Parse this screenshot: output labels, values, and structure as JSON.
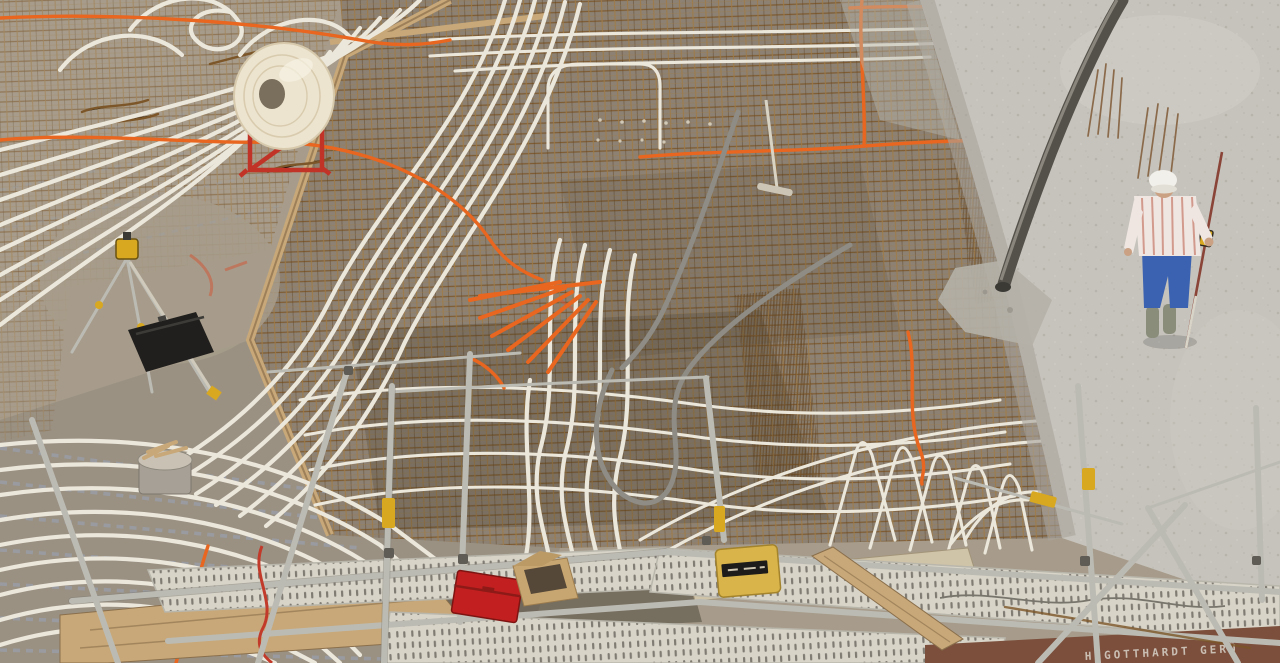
{
  "image": {
    "kind": "photograph",
    "view": "elevated aerial view, no visible UI chrome",
    "subject": "Construction site: reinforced concrete floor slab with underfloor-heating pipes and conduits being embedded while fresh concrete is poured",
    "width_px": 1280,
    "height_px": 663
  },
  "scene": {
    "description": "Elevated view over a building slab. Left: concrete deck with lattice girders and white PEX heating pipes laid in sweeping parallel curves; a large white pipe coil sits on a red spool stand; a surveyor's tripod with yellow laser level and a black equipment case stand on the slab. Center: dense rusty rebar mesh threaded with white pipes, hairpin loops, grey flexible conduit and orange electrical conduit. Right: freshly poured wet grey concrete with a dark concrete-pump hose hanging down, clusters of rebar dowels, and a worker checking the pour with a levelling staff. Foreground: scaffolding with galvanized tubes, perforated steel walkway decks, wooden planks, a red toolbox, a cardboard box and a yellow tool case.",
    "elements": [
      {
        "name": "rebar-mesh",
        "description": "rusty steel reinforcement grid covering the slab centre"
      },
      {
        "name": "heating-pipes",
        "description": "white PEX underfloor-heating tubes in parallel curves and hairpin loops"
      },
      {
        "name": "pipe-spool",
        "description": "white tubing coil on a red steel spool stand"
      },
      {
        "name": "orange-conduits",
        "description": "orange electrical conduit runs and a fanned bundle of conduit stubs"
      },
      {
        "name": "grey-conduit",
        "description": "grey flexible conduit forming a large U-loop"
      },
      {
        "name": "surveyor-tripod",
        "description": "aluminium tripod with yellow rotary laser level"
      },
      {
        "name": "equipment-case",
        "description": "black instrument case lying on the slab"
      },
      {
        "name": "fresh-concrete-pour",
        "description": "wet grey concrete surface advancing from the right"
      },
      {
        "name": "concrete-pump-hose",
        "description": "dark pump hose hanging diagonally over the pour"
      },
      {
        "name": "rebar-dowels",
        "description": "clusters of thin starter bars protruding from the fresh concrete"
      },
      {
        "name": "construction-worker",
        "description": "worker on the fresh concrete holding a levelling staff"
      },
      {
        "name": "scaffolding",
        "description": "foreground scaffold with tubes, braces and perforated walkway decks"
      },
      {
        "name": "red-toolbox",
        "description": "red metal toolbox on the walkway"
      },
      {
        "name": "cardboard-box",
        "description": "open cardboard box beside the toolbox"
      },
      {
        "name": "yellow-case",
        "description": "yellow machine case with black label on a plank"
      },
      {
        "name": "wood-plank",
        "description": "timber planks and a leaning board on the scaffold"
      },
      {
        "name": "concrete-rake",
        "description": "long-handled rake lying on the mesh"
      },
      {
        "name": "mortar-bucket",
        "description": "bucket with timber offcuts on the left slab"
      }
    ]
  },
  "worker": {
    "hard_hat": "white",
    "shirt": "white short-sleeve shirt with red stripes",
    "trousers": "blue jeans",
    "boots": "grey rubber boots",
    "equipment": "levelling staff / measuring rod"
  },
  "signage": {
    "toe_board_text": "H.GOTTHARDT GERÜ"
  },
  "palette": {
    "slabLeft": "#a79c8b",
    "slabLower": "#9a9183",
    "pit": "#7d7568",
    "meshBase": "#8c8173",
    "rust": "#7c5628",
    "rustLight": "#a07a44",
    "rustDark": "#5f3f1c",
    "freshConcrete": "#c6c3bc",
    "wetEdge": "#a8a49b",
    "tube": "#ece7db",
    "orange": "#e8661f",
    "paintRed": "#cf5a3a",
    "toolboxRed": "#c22020",
    "spoolRed": "#c23327",
    "coil": "#ede4cf",
    "steel": "#bcbbb3",
    "steelDark": "#7b7a72",
    "deck": "#d8d4c8",
    "deckSlot": "#5b564e",
    "wood": "#c8a878",
    "woodLight": "#cfc3a8",
    "woodDark": "#8a6f4c",
    "toeBoard": "#7b4f3c",
    "caseBlack": "#211f1d",
    "caseYellow": "#d9b44a",
    "tripodYellow": "#d8a820",
    "jeans": "#3a62b0",
    "shirt": "#efe6e2",
    "shirtStripe": "#cc8877",
    "skin": "#caa183",
    "boots": "#8a8d7a",
    "hose": "#54514a",
    "grayConduit": "#8e8c84",
    "lattice": "#98a0ac",
    "dowel": "#8a6a4a",
    "signText": "#d8d2c8"
  }
}
